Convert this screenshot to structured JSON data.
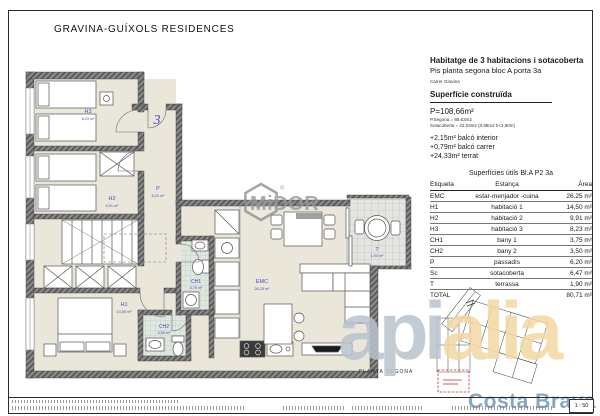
{
  "page": {
    "title": "GRAVINA-GUÍXOLS RESIDENCES",
    "scale": "1 : 50"
  },
  "unit": {
    "heading": "Habitatge de 3 habitacions i sotacoberta",
    "subheading": "Pis planta segona bloc A porta 3a",
    "street": "Carrer Gravina",
    "built_section_title": "Superfície construïda",
    "built_total": "P=108,66m²",
    "built_detail_1": "P.Segona = 86,63m2",
    "built_detail_2": "Sotacoberta = 22,03m2 (0,99m2 h<1,90m)",
    "extra_1": "+2,15m² balcó interior",
    "extra_2": "+0,79m² balcó carrer",
    "extra_3": "+24,33m² terrat"
  },
  "areas_table": {
    "title": "Superfícies útils Bl.A P2 3a",
    "headers": [
      "Etiqueta",
      "Estança",
      "Àrea"
    ],
    "rows": [
      {
        "code": "EMC",
        "room": "estar-menjador -cuina",
        "area": "26,25 m²"
      },
      {
        "code": "H1",
        "room": "habitació 1",
        "area": "14,50 m²"
      },
      {
        "code": "H2",
        "room": "habitació 2",
        "area": "9,91 m²"
      },
      {
        "code": "H3",
        "room": "habitació 3",
        "area": "8,23 m²"
      },
      {
        "code": "CH1",
        "room": "bany 1",
        "area": "3,75 m²"
      },
      {
        "code": "CH2",
        "room": "bany 2",
        "area": "3,50 m²"
      },
      {
        "code": "P",
        "room": "passadís",
        "area": "6,20 m²"
      },
      {
        "code": "Sc",
        "room": "sotacoberta",
        "area": "6,47 m²"
      },
      {
        "code": "T",
        "room": "terrassa",
        "area": "1,90 m²"
      }
    ],
    "total_label": "TOTAL",
    "total_area": "80,71 m²"
  },
  "plan": {
    "caption": "PLANTA SEGONA",
    "unit_number": "3",
    "labels": {
      "h3": {
        "code": "H3",
        "area": "8,23 m²"
      },
      "h2": {
        "code": "H2",
        "area": "9,91 m²"
      },
      "h1": {
        "code": "H1",
        "area": "14,50 m²"
      },
      "p": {
        "code": "P",
        "area": "6,20 m²"
      },
      "emc": {
        "code": "EMC",
        "area": "26,25 m²"
      },
      "ch1": {
        "code": "CH1",
        "area": "3,75 m²"
      },
      "ch2": {
        "code": "CH2",
        "area": "3,50 m²"
      },
      "t": {
        "code": "T",
        "area": "1,90 m²"
      }
    }
  },
  "watermarks": {
    "stamp": "MiDOR",
    "stamp_r": "®",
    "brand_left": "api",
    "brand_right": "alia",
    "brand_sub": "Costa Brava"
  },
  "colors": {
    "floor": "#eae6da",
    "wall": "#6b6b6b",
    "label_blue": "#4a4ac8",
    "highlight_red": "#c03030",
    "brand_tan": "#f3d9a2",
    "brand_blue": "#7d9fc0"
  }
}
